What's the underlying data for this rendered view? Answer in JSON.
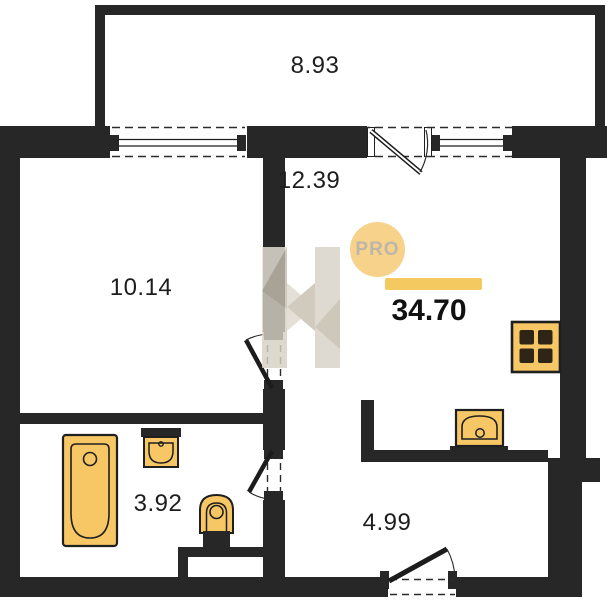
{
  "title": "One-room apartment floor plan",
  "branding": {
    "badge_label": "PRO",
    "total_area": "34.70",
    "logo_icon": "faceted-h-watermark"
  },
  "rooms": {
    "balcony": {
      "name": "balcony",
      "area": "8.93"
    },
    "hall": {
      "name": "hall-kitchen",
      "area": "12.39"
    },
    "living_room": {
      "name": "living-room",
      "area": "10.14"
    },
    "bathroom": {
      "name": "bathroom",
      "area": "3.92"
    },
    "entry": {
      "name": "entry",
      "area": "4.99"
    }
  },
  "fixtures": [
    "bathtub-icon",
    "bathroom-sink-icon",
    "toilet-icon",
    "kitchen-sink-icon",
    "stove-icon"
  ],
  "features": [
    "window",
    "balcony-door",
    "living-room-door",
    "bathroom-door",
    "entrance-door"
  ],
  "colors": {
    "wall": "#272727",
    "fixture_fill": "#f6c764",
    "fixture_stroke": "#1f1f1f",
    "badge_bg": "#f6d28b",
    "badge_text": "#bdb6a8",
    "accent_bar": "#f4c95f",
    "label_text": "#1d1d1d",
    "watermark": "#d7d1c5"
  }
}
